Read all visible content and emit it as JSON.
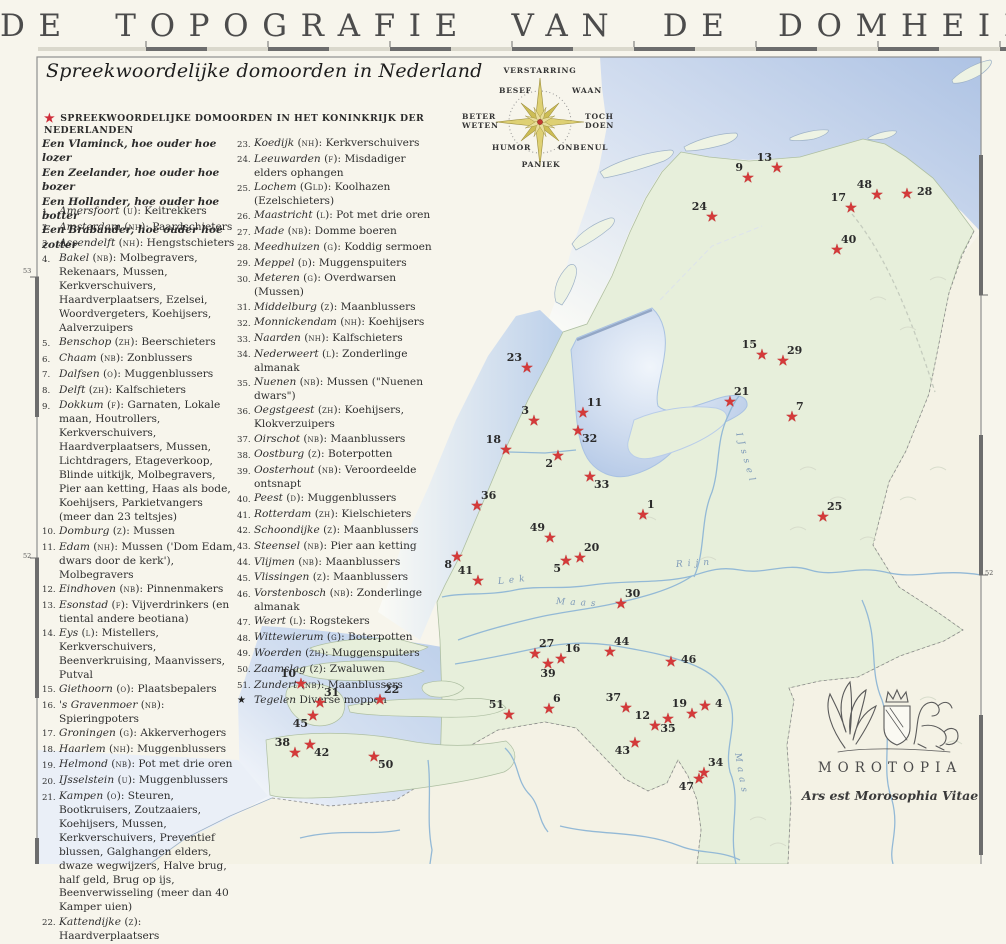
{
  "title": "DE TOPOGRAFIE VAN DE DOMHEID",
  "subtitle": "Spreekwoordelijke domoorden in Nederland",
  "legend_header": "SPREEKWOORDELIJKE DOMOORDEN IN HET KONINKRIJK DER NEDERLANDEN",
  "quotes": [
    "Een Vlaminck, hoe ouder hoe lozer",
    "Een Zeelander, hoe ouder hoe bozer",
    "Een Hollander, hoe ouder hoe botter",
    "Een Brabander, hoe ouder hoe zotter"
  ],
  "entries_col1": [
    {
      "n": 1,
      "place": "Amersfoort",
      "prov": "u",
      "desc": "Keitrekkers"
    },
    {
      "n": 2,
      "place": "Amsterdam",
      "prov": "nh",
      "desc": "Paardschieters"
    },
    {
      "n": 3,
      "place": "Assendelft",
      "prov": "nh",
      "desc": "Hengstschieters"
    },
    {
      "n": 4,
      "place": "Bakel",
      "prov": "nb",
      "desc": "Molbegravers, Rekenaars, Mussen, Kerkverschuivers, Haardverplaatsers, Ezelsei, Woordvergeters, Koehijsers, Aalverzuipers"
    },
    {
      "n": 5,
      "place": "Benschop",
      "prov": "zh",
      "desc": "Beerschieters"
    },
    {
      "n": 6,
      "place": "Chaam",
      "prov": "nb",
      "desc": "Zonblussers"
    },
    {
      "n": 7,
      "place": "Dalfsen",
      "prov": "o",
      "desc": "Muggenblussers"
    },
    {
      "n": 8,
      "place": "Delft",
      "prov": "zh",
      "desc": "Kalfschieters"
    },
    {
      "n": 9,
      "place": "Dokkum",
      "prov": "f",
      "desc": "Garnaten, Lokale maan, Houtrollers, Kerkverschuivers, Haardverplaatsers, Mussen, Lichtdragers, Etageverkoop, Blinde uitkijk, Molbegravers, Pier aan ketting, Haas als bode, Koehijsers, Parkietvangers (meer dan 23 teltsjes)"
    },
    {
      "n": 10,
      "place": "Domburg",
      "prov": "z",
      "desc": "Mussen"
    },
    {
      "n": 11,
      "place": "Edam",
      "prov": "nh",
      "desc": "Mussen ('Dom Edam, dwars door de kerk'), Molbegravers"
    },
    {
      "n": 12,
      "place": "Eindhoven",
      "prov": "nb",
      "desc": "Pinnenmakers"
    },
    {
      "n": 13,
      "place": "Esonstad",
      "prov": "f",
      "desc": "Vijverdrinkers (en tiental andere beotiana)"
    },
    {
      "n": 14,
      "place": "Eys",
      "prov": "l",
      "desc": "Mistellers, Kerkverschuivers, Beenverkruising, Maanvissers, Putval"
    },
    {
      "n": 15,
      "place": "Giethoorn",
      "prov": "o",
      "desc": "Plaatsbepalers"
    },
    {
      "n": 16,
      "place": "'s Gravenmoer",
      "prov": "nb",
      "desc": "Spieringpoters"
    },
    {
      "n": 17,
      "place": "Groningen",
      "prov": "g",
      "desc": "Akkerverhogers"
    },
    {
      "n": 18,
      "place": "Haarlem",
      "prov": "nh",
      "desc": "Muggenblussers"
    },
    {
      "n": 19,
      "place": "Helmond",
      "prov": "nb",
      "desc": "Pot met drie oren"
    },
    {
      "n": 20,
      "place": "IJsselstein",
      "prov": "u",
      "desc": "Muggenblussers"
    },
    {
      "n": 21,
      "place": "Kampen",
      "prov": "o",
      "desc": "Steuren, Bootkruisers, Zoutzaaiers, Koehijsers, Mussen, Kerkverschuivers, Preventief blussen, Galghangen elders, dwaze wegwijzers, Halve brug, half geld, Brug op ijs, Beenverwisseling (meer dan 40 Kamper uien)"
    },
    {
      "n": 22,
      "place": "Kattendijke",
      "prov": "z",
      "desc": "Haardverplaatsers"
    }
  ],
  "entries_col2": [
    {
      "n": 23,
      "place": "Koedijk",
      "prov": "nh",
      "desc": "Kerkverschuivers"
    },
    {
      "n": 24,
      "place": "Leeuwarden",
      "prov": "f",
      "desc": "Misdadiger elders ophangen"
    },
    {
      "n": 25,
      "place": "Lochem",
      "prov": "Gld",
      "desc": "Koolhazen (Ezelschieters)"
    },
    {
      "n": 26,
      "place": "Maastricht",
      "prov": "l",
      "desc": "Pot met drie oren"
    },
    {
      "n": 27,
      "place": "Made",
      "prov": "nb",
      "desc": "Domme boeren"
    },
    {
      "n": 28,
      "place": "Meedhuizen",
      "prov": "g",
      "desc": "Koddig sermoen"
    },
    {
      "n": 29,
      "place": "Meppel",
      "prov": "d",
      "desc": "Muggenspuiters"
    },
    {
      "n": 30,
      "place": "Meteren",
      "prov": "g",
      "desc": "Overdwarsen (Mussen)"
    },
    {
      "n": 31,
      "place": "Middelburg",
      "prov": "z",
      "desc": "Maanblussers"
    },
    {
      "n": 32,
      "place": "Monnickendam",
      "prov": "nh",
      "desc": "Koehijsers"
    },
    {
      "n": 33,
      "place": "Naarden",
      "prov": "nh",
      "desc": "Kalfschieters"
    },
    {
      "n": 34,
      "place": "Nederweert",
      "prov": "l",
      "desc": "Zonderlinge almanak"
    },
    {
      "n": 35,
      "place": "Nuenen",
      "prov": "nb",
      "desc": "Mussen (\"Nuenen dwars\")"
    },
    {
      "n": 36,
      "place": "Oegstgeest",
      "prov": "zh",
      "desc": "Koehijsers, Klokverzuipers"
    },
    {
      "n": 37,
      "place": "Oirschot",
      "prov": "nb",
      "desc": "Maanblussers"
    },
    {
      "n": 38,
      "place": "Oostburg",
      "prov": "z",
      "desc": "Boterpotten"
    },
    {
      "n": 39,
      "place": "Oosterhout",
      "prov": "nb",
      "desc": "Veroordeelde ontsnapt"
    },
    {
      "n": 40,
      "place": "Peest",
      "prov": "d",
      "desc": "Muggenblussers"
    },
    {
      "n": 41,
      "place": "Rotterdam",
      "prov": "zh",
      "desc": "Kielschieters"
    },
    {
      "n": 42,
      "place": "Schoondijke",
      "prov": "z",
      "desc": "Maanblussers"
    },
    {
      "n": 43,
      "place": "Steensel",
      "prov": "nb",
      "desc": "Pier aan ketting"
    },
    {
      "n": 44,
      "place": "Vlijmen",
      "prov": "nb",
      "desc": "Maanblussers"
    },
    {
      "n": 45,
      "place": "Vlissingen",
      "prov": "z",
      "desc": "Maanblussers"
    },
    {
      "n": 46,
      "place": "Vorstenbosch",
      "prov": "nb",
      "desc": "Zonderlinge almanak"
    },
    {
      "n": 47,
      "place": "Weert",
      "prov": "l",
      "desc": "Rogstekers"
    },
    {
      "n": 48,
      "place": "Wittewierum",
      "prov": "g",
      "desc": "Boterpotten"
    },
    {
      "n": 49,
      "place": "Woerden",
      "prov": "zh",
      "desc": "Muggenspuiters"
    },
    {
      "n": 50,
      "place": "Zaamslag",
      "prov": "z",
      "desc": "Zwaluwen"
    },
    {
      "n": 51,
      "place": "Zundert",
      "prov": "nb",
      "desc": "Maanblussers"
    }
  ],
  "special_entry": {
    "symbol": "★",
    "place": "Tegelen",
    "desc": "Diverse moppen"
  },
  "compass": {
    "n": "VERSTARRING",
    "ne": "WAAN",
    "e": "TOCH DOEN",
    "se": "ONBENUL",
    "s": "PANIEK",
    "sw": "HUMOR",
    "w": "BETER WETEN",
    "nw": "BESEF"
  },
  "map": {
    "stars": [
      {
        "n": 13,
        "x": 777,
        "y": 168,
        "pos": "tl"
      },
      {
        "n": 9,
        "x": 748,
        "y": 178,
        "pos": "tl"
      },
      {
        "n": 24,
        "x": 712,
        "y": 217,
        "pos": "tl"
      },
      {
        "n": 48,
        "x": 877,
        "y": 195,
        "pos": "tl"
      },
      {
        "n": 17,
        "x": 851,
        "y": 208,
        "pos": "tl"
      },
      {
        "n": 28,
        "x": 907,
        "y": 194,
        "pos": "r"
      },
      {
        "n": 40,
        "x": 837,
        "y": 250,
        "pos": "tr"
      },
      {
        "n": 15,
        "x": 762,
        "y": 355,
        "pos": "tl"
      },
      {
        "n": 29,
        "x": 783,
        "y": 361,
        "pos": "tr"
      },
      {
        "n": 21,
        "x": 730,
        "y": 402,
        "pos": "tr"
      },
      {
        "n": 7,
        "x": 792,
        "y": 417,
        "pos": "tr"
      },
      {
        "n": 23,
        "x": 527,
        "y": 368,
        "pos": "tl"
      },
      {
        "n": 3,
        "x": 534,
        "y": 421,
        "pos": "tl"
      },
      {
        "n": 11,
        "x": 583,
        "y": 413,
        "pos": "tr"
      },
      {
        "n": 32,
        "x": 578,
        "y": 431,
        "pos": "br"
      },
      {
        "n": 18,
        "x": 506,
        "y": 450,
        "pos": "tl"
      },
      {
        "n": 2,
        "x": 558,
        "y": 456,
        "pos": "bl"
      },
      {
        "n": 33,
        "x": 590,
        "y": 477,
        "pos": "br"
      },
      {
        "n": 36,
        "x": 477,
        "y": 506,
        "pos": "tr"
      },
      {
        "n": 1,
        "x": 643,
        "y": 515,
        "pos": "tr"
      },
      {
        "n": 25,
        "x": 823,
        "y": 517,
        "pos": "tr"
      },
      {
        "n": 49,
        "x": 550,
        "y": 538,
        "pos": "tl"
      },
      {
        "n": 20,
        "x": 580,
        "y": 558,
        "pos": "tr"
      },
      {
        "n": 5,
        "x": 566,
        "y": 561,
        "pos": "bl"
      },
      {
        "n": 8,
        "x": 457,
        "y": 557,
        "pos": "bl"
      },
      {
        "n": 41,
        "x": 478,
        "y": 581,
        "pos": "tl"
      },
      {
        "n": 30,
        "x": 621,
        "y": 604,
        "pos": "tr"
      },
      {
        "n": 27,
        "x": 535,
        "y": 654,
        "pos": "tr"
      },
      {
        "n": 16,
        "x": 561,
        "y": 659,
        "pos": "tr"
      },
      {
        "n": 39,
        "x": 548,
        "y": 664,
        "pos": "b"
      },
      {
        "n": 44,
        "x": 610,
        "y": 652,
        "pos": "tr"
      },
      {
        "n": 46,
        "x": 671,
        "y": 662,
        "pos": "r"
      },
      {
        "n": 10,
        "x": 301,
        "y": 684,
        "pos": "tl"
      },
      {
        "n": 31,
        "x": 320,
        "y": 703,
        "pos": "tr"
      },
      {
        "n": 22,
        "x": 380,
        "y": 700,
        "pos": "tr"
      },
      {
        "n": 45,
        "x": 313,
        "y": 716,
        "pos": "bl"
      },
      {
        "n": 38,
        "x": 295,
        "y": 753,
        "pos": "tl"
      },
      {
        "n": 42,
        "x": 310,
        "y": 745,
        "pos": "br"
      },
      {
        "n": 50,
        "x": 374,
        "y": 757,
        "pos": "br"
      },
      {
        "n": 51,
        "x": 509,
        "y": 715,
        "pos": "tl"
      },
      {
        "n": 6,
        "x": 549,
        "y": 709,
        "pos": "tr"
      },
      {
        "n": 37,
        "x": 626,
        "y": 708,
        "pos": "tl"
      },
      {
        "n": 12,
        "x": 655,
        "y": 726,
        "pos": "tl"
      },
      {
        "n": 35,
        "x": 668,
        "y": 719,
        "pos": "b"
      },
      {
        "n": 19,
        "x": 692,
        "y": 714,
        "pos": "tl"
      },
      {
        "n": 4,
        "x": 705,
        "y": 706,
        "pos": "r"
      },
      {
        "n": 43,
        "x": 635,
        "y": 743,
        "pos": "bl"
      },
      {
        "n": 34,
        "x": 704,
        "y": 773,
        "pos": "tr"
      },
      {
        "n": 47,
        "x": 699,
        "y": 779,
        "pos": "bl"
      }
    ],
    "river_labels": [
      {
        "text": "Lek",
        "x": 498,
        "y": 577,
        "angle": -6
      },
      {
        "text": "Rijn",
        "x": 676,
        "y": 560,
        "angle": -4
      },
      {
        "text": "Maas",
        "x": 556,
        "y": 597,
        "angle": 3
      },
      {
        "text": "Maas",
        "x": 737,
        "y": 748,
        "angle": 80
      },
      {
        "text": "IJssel",
        "x": 738,
        "y": 428,
        "angle": 74
      }
    ],
    "lat_labels": [
      {
        "text": "53",
        "x": 23,
        "y": 267
      },
      {
        "text": "52",
        "x": 23,
        "y": 552
      },
      {
        "text": "52",
        "x": 985,
        "y": 569
      }
    ]
  },
  "emblem": {
    "name": "MOROTOPIA",
    "motto": "Ars est Morosophia Vitae"
  },
  "colors": {
    "star_red": "#d43a3a",
    "sea_blue": "#b7c9e6",
    "land_green": "#e7efdb",
    "neighbor_cream": "#f4f2e5",
    "compass_gold": "#d9c95e",
    "frame_gray": "#6d6d6d"
  }
}
